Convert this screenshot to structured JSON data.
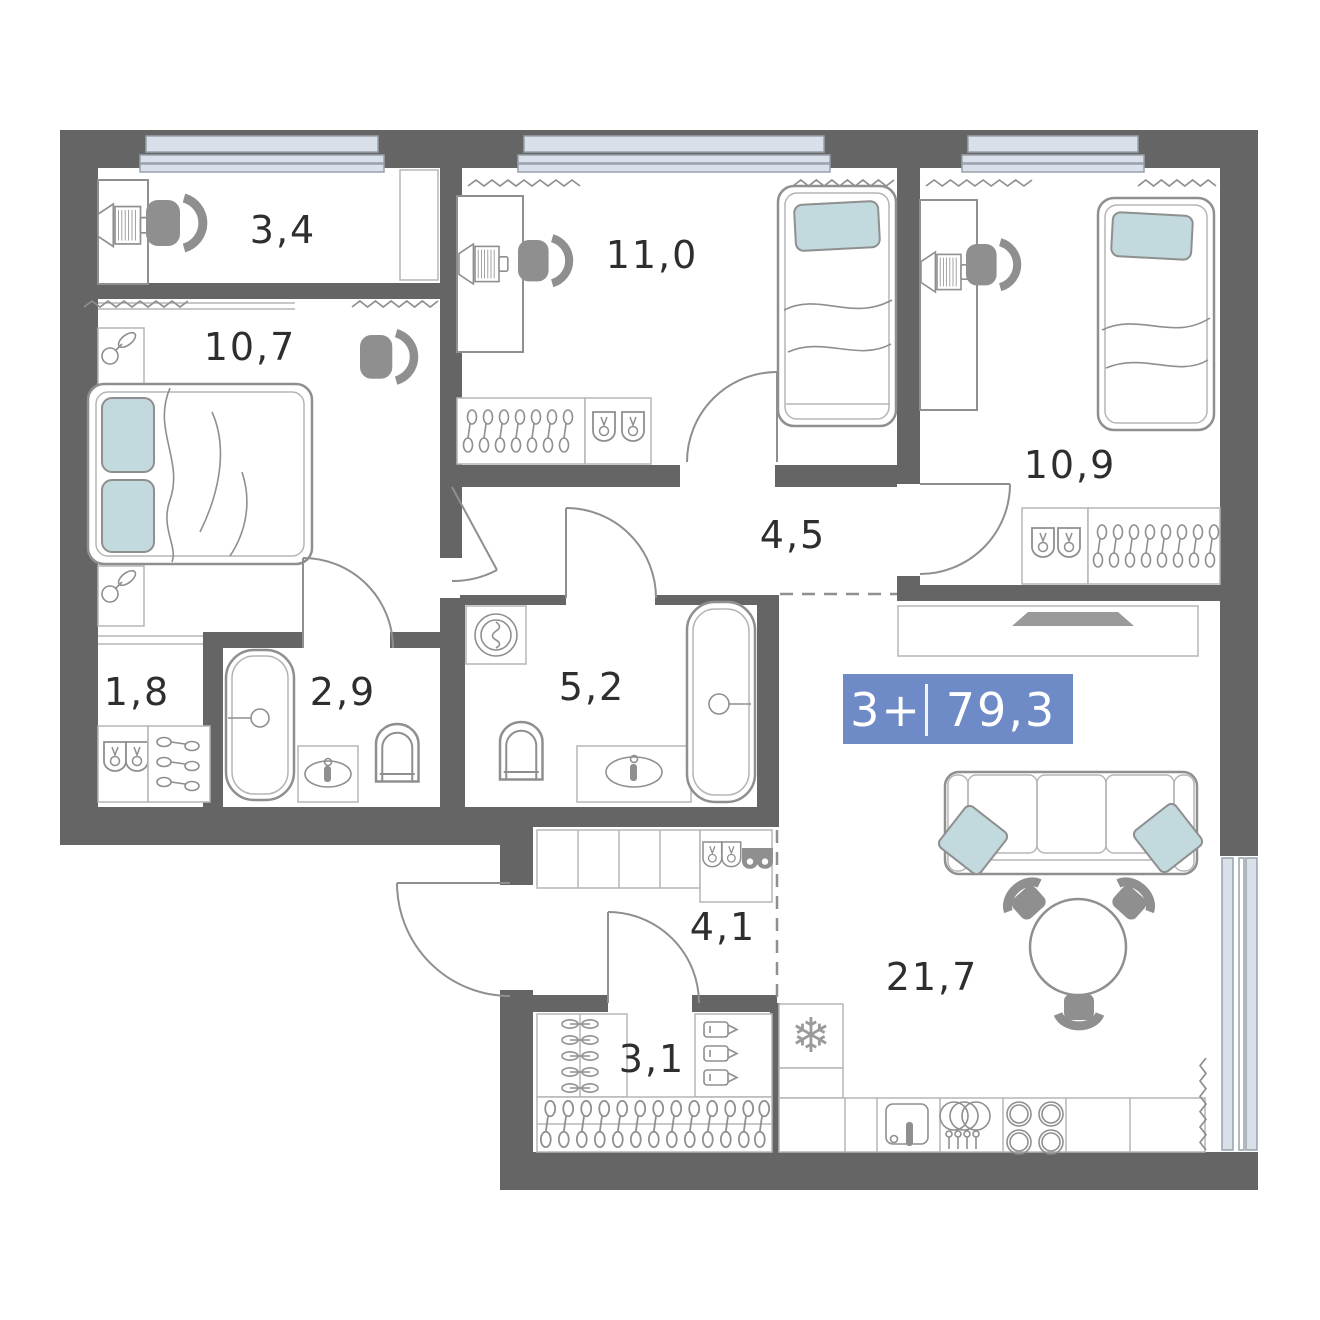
{
  "badge": {
    "rooms_label": "3+",
    "area_total": "79,3"
  },
  "rooms": [
    {
      "name": "study",
      "area": "3,4"
    },
    {
      "name": "bedroom-1",
      "area": "10,7"
    },
    {
      "name": "bedroom-2",
      "area": "11,0"
    },
    {
      "name": "bedroom-3",
      "area": "10,9"
    },
    {
      "name": "hallway",
      "area": "4,5"
    },
    {
      "name": "closet",
      "area": "1,8"
    },
    {
      "name": "bathroom-1",
      "area": "2,9"
    },
    {
      "name": "bathroom-2",
      "area": "5,2"
    },
    {
      "name": "entry-hall",
      "area": "4,1"
    },
    {
      "name": "storage",
      "area": "3,1"
    },
    {
      "name": "living-kitchen",
      "area": "21,7"
    }
  ],
  "icons": {
    "snowflake": "❄"
  },
  "colors": {
    "wall": "#656565",
    "furniture_line": "#8f8f8f",
    "light_line": "#b5b5b5",
    "window_fill": "#d9e0ea",
    "pillow_fill": "#c2d9de",
    "badge_bg": "#6f8bc7",
    "badge_text": "#ffffff",
    "label_text": "#2e2e2e"
  }
}
